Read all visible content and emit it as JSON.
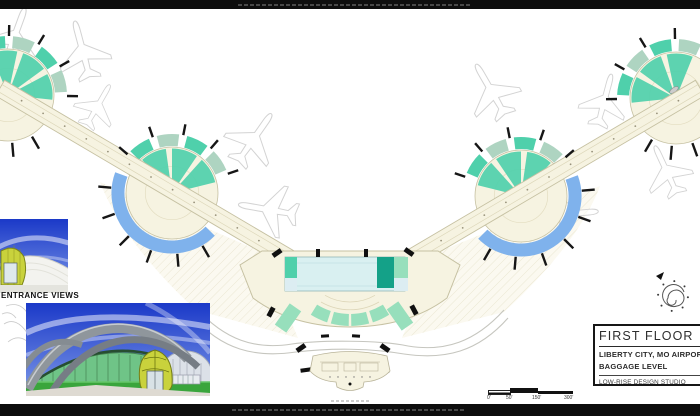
{
  "sheet": {
    "title_block": {
      "title": "FIRST FLOOR",
      "project_line1": "LIBERTY CITY, MO AIRPORT",
      "project_line2": "BAGGAGE LEVEL",
      "studio": "LOW-RISE DESIGN STUDIO"
    },
    "labels": {
      "entrance_views": "ENTRANCE VIEWS"
    },
    "scale_bar": {
      "tick_labels": [
        "0'",
        "50'",
        "150'",
        "300'"
      ]
    },
    "icons": {
      "north_arrow": "north-arrow-icon",
      "airplane": "airplane-icon",
      "satellite_gate": "satellite-gate"
    },
    "colors": {
      "mint": "#4fd0ab",
      "mint_light": "#97dfbc",
      "sage": "#aed4c1",
      "teal_dark": "#14a188",
      "blue_arc": "#7fb2ec",
      "cream": "#f6f3e1",
      "glass": "#d9f0f1",
      "sky_top": "#1b39c8",
      "sky_bottom": "#7e9ae8",
      "grass": "#3aa53c",
      "dome_yellow": "#c9d23c"
    }
  }
}
